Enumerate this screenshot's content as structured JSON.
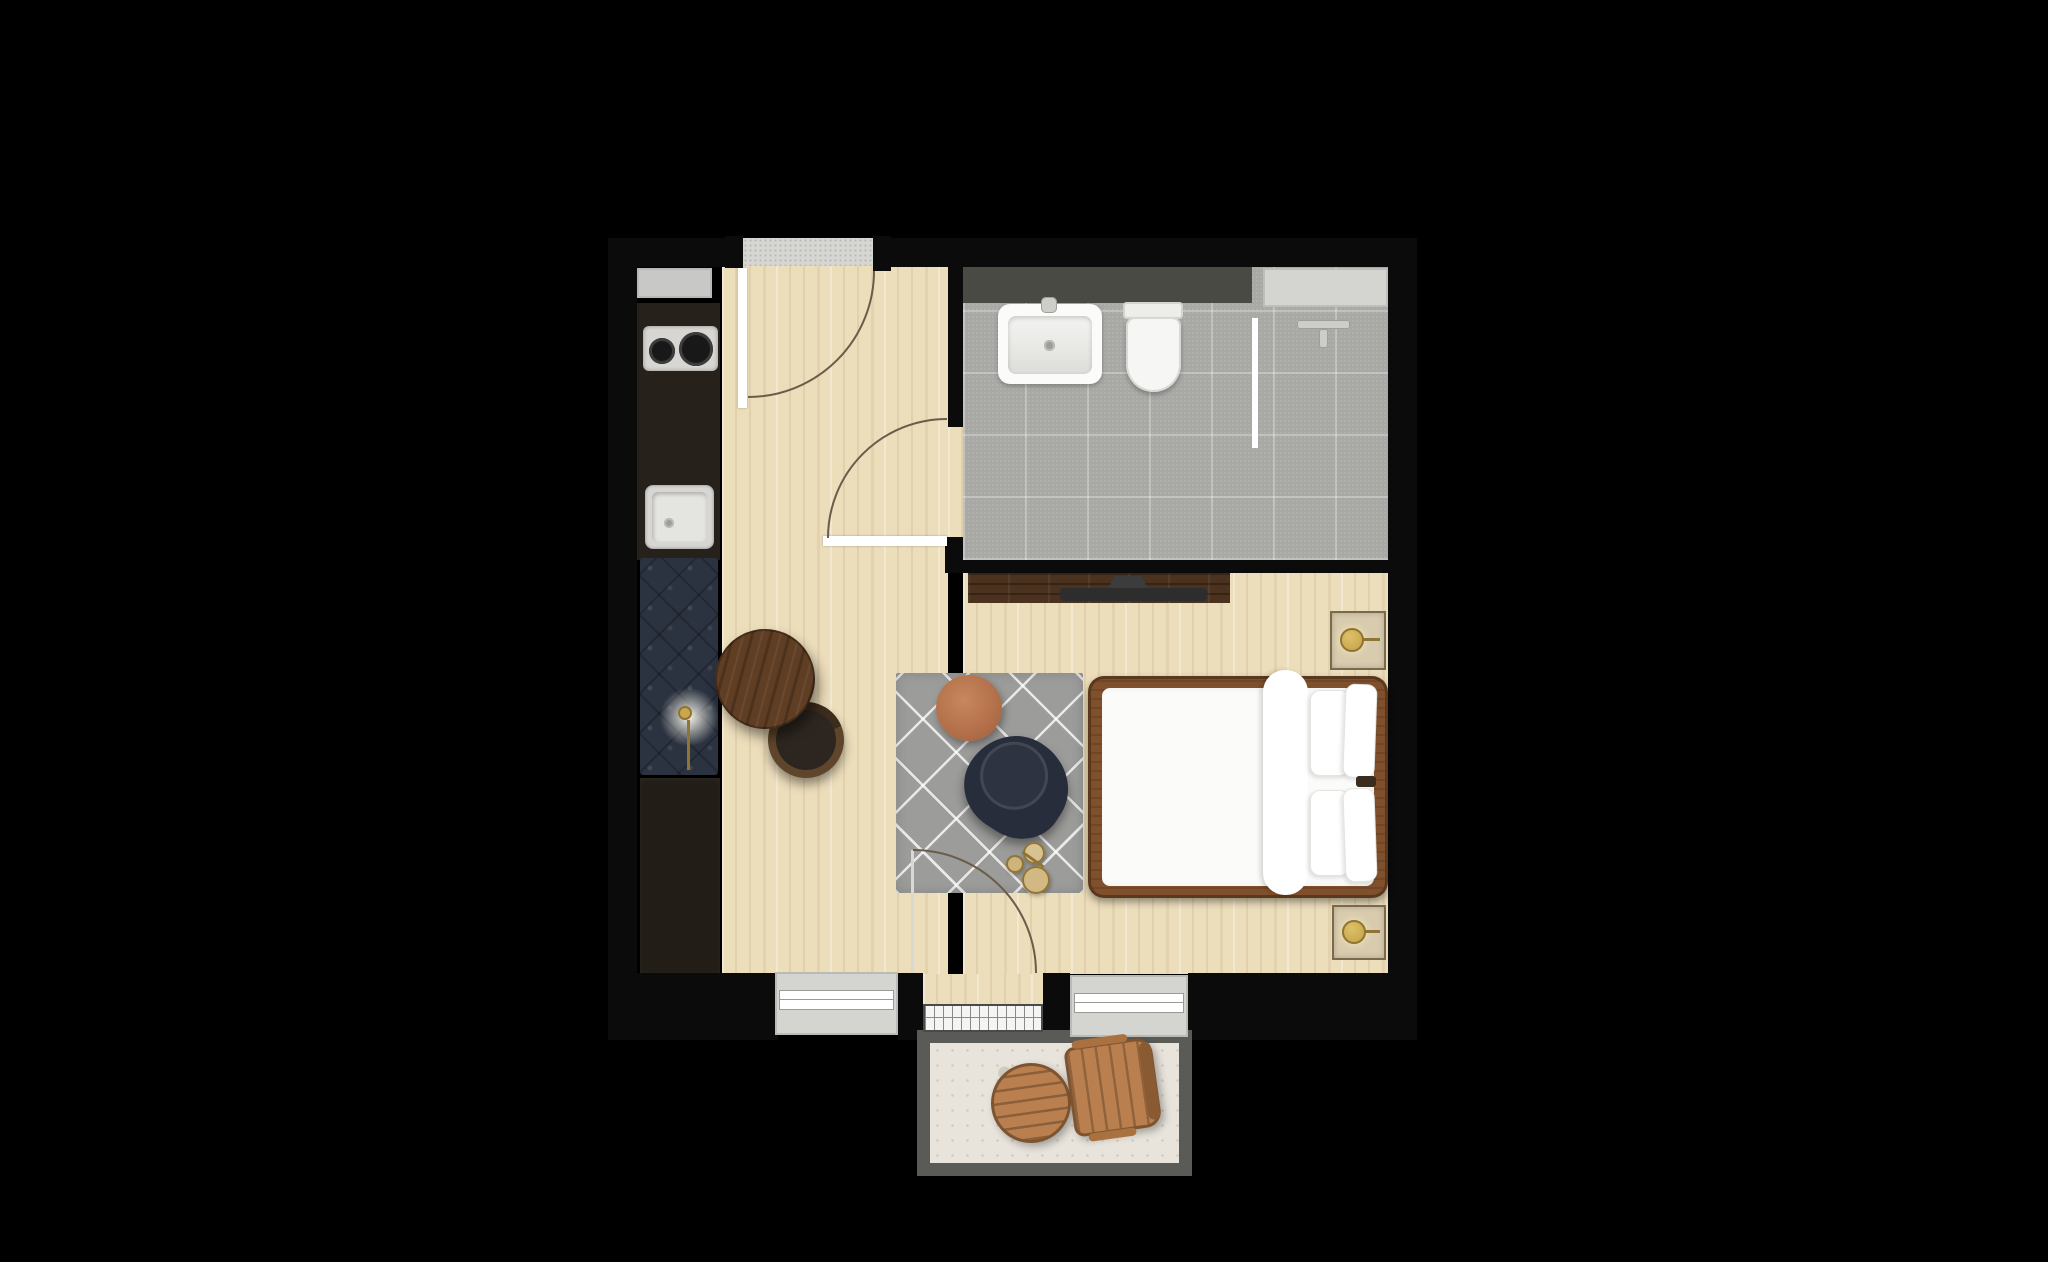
{
  "document": {
    "title": "Studio apartment floor plan",
    "type": "top-down 3D floor plan rendering",
    "background": "#000000"
  },
  "palette": {
    "bg": "#000000",
    "wall": "#0b0b0b",
    "wood": "#ecddbb",
    "tile": "#a8a8a5",
    "threshold": "#d6d6d3",
    "counter": "#26211a",
    "fridge": "#c8c8c6",
    "steel": "#d8d6d2",
    "burner": "#181818",
    "bench": "#2b3240",
    "wardrobe": "#221d17",
    "vanity": "#4a4a45",
    "window-gray": "#d4d4d1",
    "console": "#4a321f",
    "tv": "#2d2d2d",
    "table-walnut": "#5f3e24",
    "stool": "#2d2620",
    "rug": "#9c9c9a",
    "pouf": "#b4714b",
    "chair-navy": "#272d3a",
    "brass": "#c9a84e",
    "bed-frame": "#80502c",
    "bedding": "#fbfbf9",
    "nightstand": "#d8cbae",
    "rail": "#5a5a56",
    "balcony-floor": "#e8e4dc",
    "outdoor-wood": "#b97f4e",
    "arc": "#6b5c4a"
  },
  "rooms": {
    "entry_hall": {
      "label": "Entry hall"
    },
    "kitchenette": {
      "label": "Kitchenette"
    },
    "bathroom": {
      "label": "Bathroom"
    },
    "living_sleeping": {
      "label": "Living / sleeping area"
    },
    "balcony": {
      "label": "Balcony"
    }
  },
  "furniture": {
    "entry_door": {
      "label": "Entry door with swing"
    },
    "fridge": {
      "label": "Refrigerator"
    },
    "cooktop": {
      "label": "Two-burner cooktop"
    },
    "kitchen_sink": {
      "label": "Kitchen sink"
    },
    "bench": {
      "label": "Navy tufted bench"
    },
    "floor_lamp": {
      "label": "Floor lamp (lit)"
    },
    "wardrobe": {
      "label": "Wardrobe / storage"
    },
    "vanity": {
      "label": "Bathroom vanity counter"
    },
    "basin": {
      "label": "Wash basin"
    },
    "toilet": {
      "label": "Toilet"
    },
    "shower_fixture": {
      "label": "Shower mixer bar"
    },
    "shower_screen": {
      "label": "Glass shower screen"
    },
    "bathroom_window": {
      "label": "Bathroom window"
    },
    "bathroom_door": {
      "label": "Bathroom door with swing"
    },
    "tv_console": {
      "label": "TV console sideboard"
    },
    "tv": {
      "label": "Television"
    },
    "coffee_table": {
      "label": "Round walnut coffee table"
    },
    "stool": {
      "label": "Leather stool"
    },
    "rug": {
      "label": "Gray diamond-pattern rug"
    },
    "pouf": {
      "label": "Terracotta pouf"
    },
    "lounge_chair": {
      "label": "Navy lounge chair"
    },
    "side_tables": {
      "label": "Brass side tables"
    },
    "bed": {
      "label": "Double bed"
    },
    "duvet": {
      "label": "Folded duvet"
    },
    "pillow": {
      "label": "Pillow"
    },
    "nightstand_top": {
      "label": "Nightstand with brass lamp"
    },
    "nightstand_bottom": {
      "label": "Nightstand with brass lamp"
    },
    "balcony_door": {
      "label": "Balcony door with swing"
    },
    "window_left": {
      "label": "Window"
    },
    "window_right": {
      "label": "Window"
    },
    "balcony_table": {
      "label": "Outdoor round wood table"
    },
    "balcony_chair": {
      "label": "Outdoor wood armchair"
    }
  }
}
